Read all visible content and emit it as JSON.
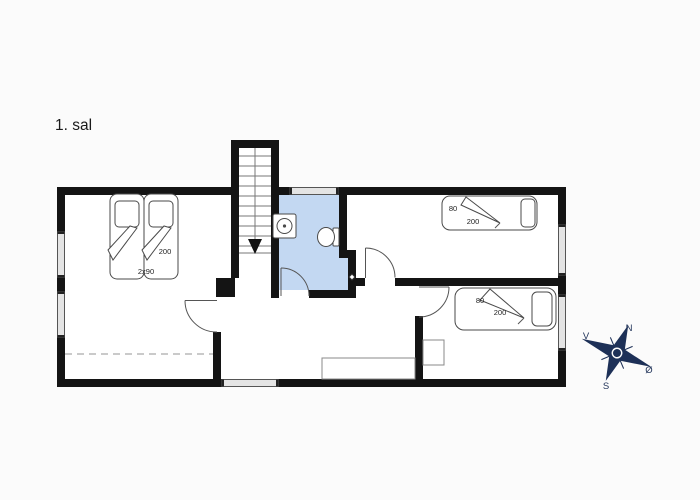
{
  "page": {
    "title": "1. sal",
    "background": "#fbfbfb"
  },
  "floor_plan": {
    "colors": {
      "wall": "#141414",
      "bathroom_fill": "#c3d8f2",
      "window_fill": "#e4e4e4",
      "furniture_stroke": "#4a4a4a",
      "compass": "#1d3057"
    },
    "rooms": {
      "bedroom_left": {
        "bed_type": "double-bed",
        "bed_width_label": "2x90",
        "bed_length_label": "200"
      },
      "bedroom_top_right": {
        "bed_type": "single-bed",
        "bed_width_label": "80",
        "bed_length_label": "200"
      },
      "bedroom_bottom_right": {
        "bed_type": "single-bed",
        "bed_width_label": "80",
        "bed_length_label": "200"
      }
    },
    "bathroom_fixtures": [
      "sink",
      "toilet"
    ],
    "staircase": {
      "arrow": "down"
    }
  },
  "compass": {
    "north": "N",
    "east": "Ø",
    "south": "S",
    "west": "V"
  }
}
